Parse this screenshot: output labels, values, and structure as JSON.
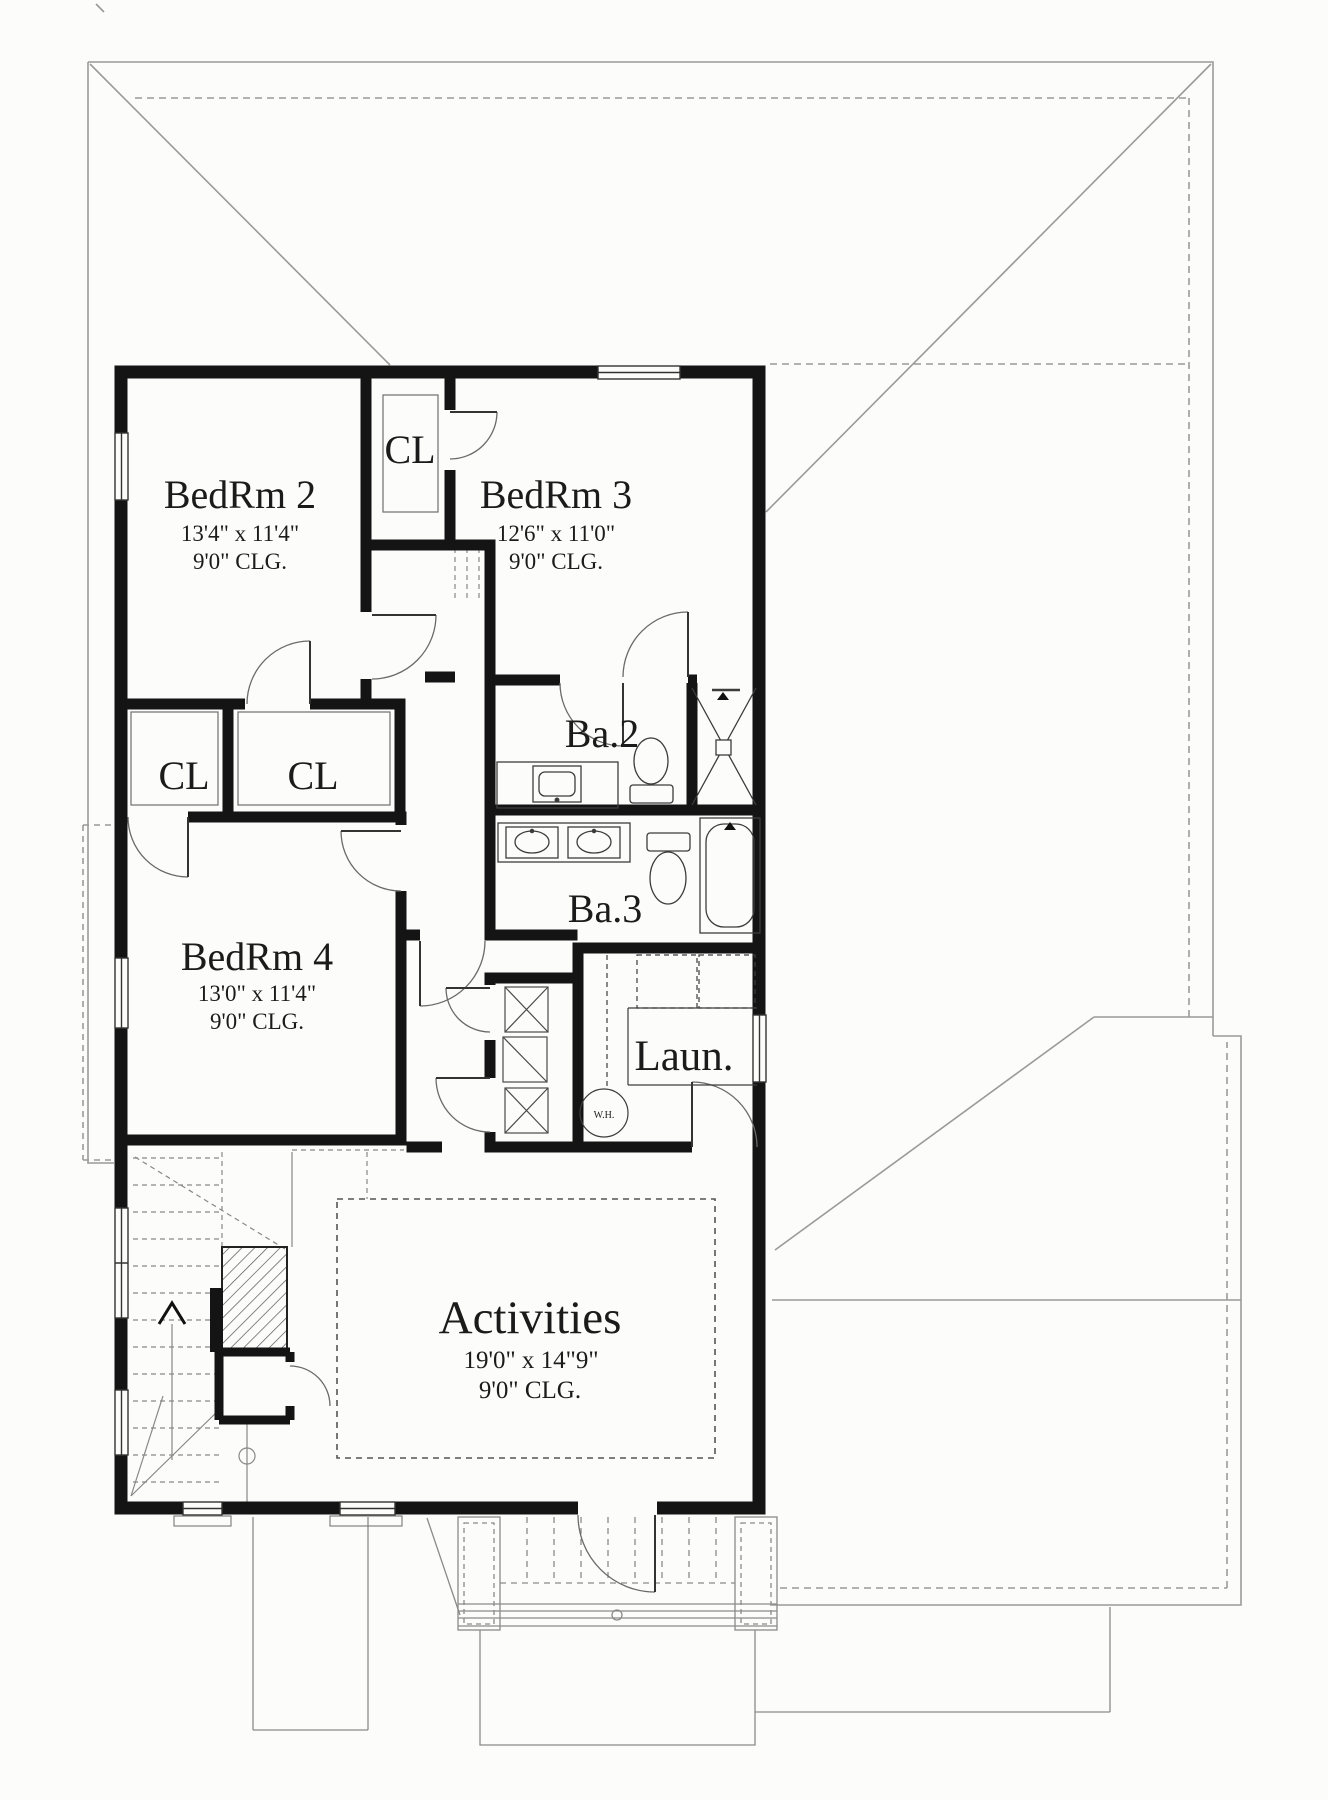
{
  "plan": {
    "title": "Second floor plan",
    "rooms": [
      {
        "id": "bedrm2",
        "name": "BedRm 2",
        "dims": "13'4\" x 11'4\"",
        "ceiling": "9'0\" CLG."
      },
      {
        "id": "closet_top",
        "name": "CL"
      },
      {
        "id": "bedrm3",
        "name": "BedRm 3",
        "dims": "12'6\" x 11'0\"",
        "ceiling": "9'0\" CLG."
      },
      {
        "id": "bath2",
        "name": "Ba.2"
      },
      {
        "id": "closet_left",
        "name": "CL"
      },
      {
        "id": "closet_mid",
        "name": "CL"
      },
      {
        "id": "bath3",
        "name": "Ba.3"
      },
      {
        "id": "bedrm4",
        "name": "BedRm 4",
        "dims": "13'0\" x 11'4\"",
        "ceiling": "9'0\" CLG."
      },
      {
        "id": "laundry",
        "name": "Laun."
      },
      {
        "id": "activities",
        "name": "Activities",
        "dims": "19'0\" x 14\"9\"",
        "ceiling": "9'0\" CLG."
      }
    ],
    "annotations": {
      "water_heater": "W.H."
    },
    "colors": {
      "wall": "#141414",
      "fixture": "#3c3c3c",
      "door": "#6a6a6a",
      "roof": "#9a9a9a",
      "background": "#fcfcfb"
    }
  }
}
